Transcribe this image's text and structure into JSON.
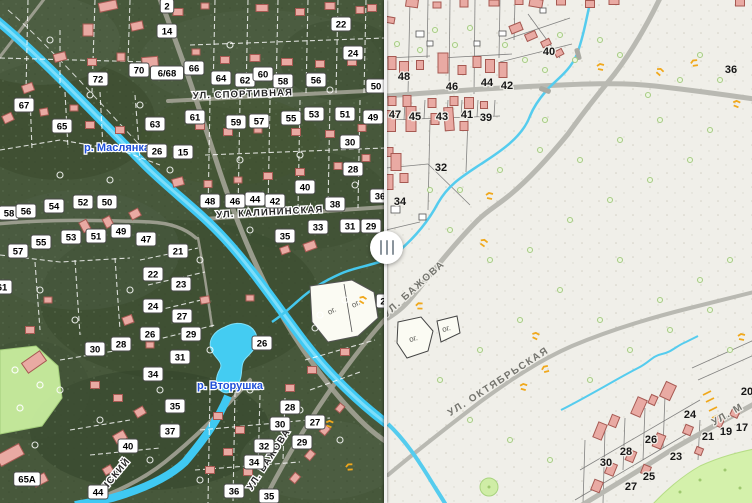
{
  "compare_slider": {
    "grip_icon": "drag-handle-icon",
    "position_x": 386
  },
  "left_map": {
    "style": "satellite-with-cadastral-overlay",
    "street_labels": [
      {
        "text": "УЛ. СПОРТИВНАЯ",
        "x": 243,
        "y": 97,
        "rotate": -2
      },
      {
        "text": "УЛ. КАЛИНИНСКАЯ",
        "x": 270,
        "y": 215,
        "rotate": -3
      },
      {
        "text": "УЛ. БАЖОВА",
        "x": 271,
        "y": 461,
        "rotate": -57
      },
      {
        "text": "НСКИЙ",
        "x": 118,
        "y": 476,
        "rotate": -50
      }
    ],
    "water_labels": [
      {
        "text": "р. Маслянка",
        "x": 117,
        "y": 151
      },
      {
        "text": "р. Вторушка",
        "x": 230,
        "y": 389
      }
    ],
    "parcel_labels": [
      {
        "text": "ог.",
        "x": 333,
        "y": 313,
        "rotate": -28
      },
      {
        "text": "ог.",
        "x": 357,
        "y": 306,
        "rotate": -28
      }
    ],
    "house_numbers": [
      {
        "n": "2",
        "x": 167,
        "y": 6
      },
      {
        "n": "14",
        "x": 167,
        "y": 31
      },
      {
        "n": "72",
        "x": 98,
        "y": 79
      },
      {
        "n": "70",
        "x": 139,
        "y": 70
      },
      {
        "n": "6/68",
        "x": 167,
        "y": 73
      },
      {
        "n": "66",
        "x": 194,
        "y": 68
      },
      {
        "n": "67",
        "x": 24,
        "y": 105
      },
      {
        "n": "65",
        "x": 62,
        "y": 126
      },
      {
        "n": "22",
        "x": 341,
        "y": 24
      },
      {
        "n": "24",
        "x": 353,
        "y": 53
      },
      {
        "n": "64",
        "x": 221,
        "y": 78
      },
      {
        "n": "62",
        "x": 245,
        "y": 80
      },
      {
        "n": "60",
        "x": 263,
        "y": 74
      },
      {
        "n": "58",
        "x": 283,
        "y": 81
      },
      {
        "n": "56",
        "x": 316,
        "y": 80
      },
      {
        "n": "50",
        "x": 376,
        "y": 86
      },
      {
        "n": "61",
        "x": 195,
        "y": 117
      },
      {
        "n": "59",
        "x": 236,
        "y": 122
      },
      {
        "n": "57",
        "x": 259,
        "y": 121
      },
      {
        "n": "55",
        "x": 291,
        "y": 118
      },
      {
        "n": "53",
        "x": 314,
        "y": 114
      },
      {
        "n": "51",
        "x": 345,
        "y": 114
      },
      {
        "n": "49",
        "x": 373,
        "y": 117
      },
      {
        "n": "63",
        "x": 155,
        "y": 124
      },
      {
        "n": "15",
        "x": 183,
        "y": 152
      },
      {
        "n": "26",
        "x": 157,
        "y": 151
      },
      {
        "n": "30",
        "x": 350,
        "y": 142
      },
      {
        "n": "28",
        "x": 353,
        "y": 169
      },
      {
        "n": "40",
        "x": 305,
        "y": 187
      },
      {
        "n": "48",
        "x": 210,
        "y": 201
      },
      {
        "n": "46",
        "x": 235,
        "y": 201
      },
      {
        "n": "44",
        "x": 255,
        "y": 199
      },
      {
        "n": "42",
        "x": 275,
        "y": 201
      },
      {
        "n": "38",
        "x": 335,
        "y": 204
      },
      {
        "n": "36",
        "x": 380,
        "y": 196
      },
      {
        "n": "33",
        "x": 318,
        "y": 227
      },
      {
        "n": "31",
        "x": 350,
        "y": 226
      },
      {
        "n": "29",
        "x": 371,
        "y": 226
      },
      {
        "n": "35",
        "x": 285,
        "y": 236
      },
      {
        "n": "58",
        "x": 9,
        "y": 213
      },
      {
        "n": "56",
        "x": 26,
        "y": 211
      },
      {
        "n": "54",
        "x": 54,
        "y": 206
      },
      {
        "n": "52",
        "x": 83,
        "y": 202
      },
      {
        "n": "50",
        "x": 107,
        "y": 202
      },
      {
        "n": "57",
        "x": 18,
        "y": 251
      },
      {
        "n": "55",
        "x": 41,
        "y": 242
      },
      {
        "n": "53",
        "x": 71,
        "y": 237
      },
      {
        "n": "51",
        "x": 96,
        "y": 236
      },
      {
        "n": "49",
        "x": 121,
        "y": 231
      },
      {
        "n": "47",
        "x": 146,
        "y": 239
      },
      {
        "n": "21",
        "x": 178,
        "y": 251
      },
      {
        "n": "22",
        "x": 153,
        "y": 274
      },
      {
        "n": "23",
        "x": 181,
        "y": 284
      },
      {
        "n": "24",
        "x": 153,
        "y": 306
      },
      {
        "n": "27",
        "x": 182,
        "y": 316
      },
      {
        "n": "26",
        "x": 150,
        "y": 334
      },
      {
        "n": "29",
        "x": 191,
        "y": 334
      },
      {
        "n": "61",
        "x": 2,
        "y": 287
      },
      {
        "n": "30",
        "x": 95,
        "y": 349
      },
      {
        "n": "28",
        "x": 121,
        "y": 344
      },
      {
        "n": "31",
        "x": 180,
        "y": 357
      },
      {
        "n": "34",
        "x": 153,
        "y": 374
      },
      {
        "n": "35",
        "x": 175,
        "y": 406
      },
      {
        "n": "37",
        "x": 170,
        "y": 431
      },
      {
        "n": "40",
        "x": 128,
        "y": 446
      },
      {
        "n": "44",
        "x": 98,
        "y": 492
      },
      {
        "n": "65А",
        "x": 27,
        "y": 479
      },
      {
        "n": "26",
        "x": 262,
        "y": 343
      },
      {
        "n": "28",
        "x": 290,
        "y": 407
      },
      {
        "n": "30",
        "x": 280,
        "y": 424
      },
      {
        "n": "32",
        "x": 264,
        "y": 446
      },
      {
        "n": "34",
        "x": 254,
        "y": 462
      },
      {
        "n": "36",
        "x": 234,
        "y": 491
      },
      {
        "n": "35",
        "x": 269,
        "y": 496
      },
      {
        "n": "29",
        "x": 302,
        "y": 442
      },
      {
        "n": "27",
        "x": 315,
        "y": 422
      },
      {
        "n": "2",
        "x": 383,
        "y": 301
      }
    ]
  },
  "right_map": {
    "style": "vector-cadastral",
    "street_labels": [
      {
        "text": "УЛ. БАЖОВА",
        "x": 416,
        "y": 291,
        "rotate": -42
      },
      {
        "text": "УЛ. ОКТЯБРЬСКАЯ",
        "x": 500,
        "y": 384,
        "rotate": -33
      },
      {
        "text": "УЛ. М",
        "x": 729,
        "y": 417,
        "rotate": -30
      }
    ],
    "parcel_labels": [
      {
        "text": "ог.",
        "x": 414,
        "y": 341,
        "rotate": -15
      },
      {
        "text": "ог.",
        "x": 447,
        "y": 331,
        "rotate": -15
      }
    ],
    "house_numbers": [
      {
        "n": "48",
        "x": 404,
        "y": 76
      },
      {
        "n": "46",
        "x": 452,
        "y": 86
      },
      {
        "n": "44",
        "x": 487,
        "y": 82
      },
      {
        "n": "42",
        "x": 507,
        "y": 85
      },
      {
        "n": "40",
        "x": 549,
        "y": 51
      },
      {
        "n": "47",
        "x": 395,
        "y": 114
      },
      {
        "n": "45",
        "x": 415,
        "y": 116
      },
      {
        "n": "43",
        "x": 442,
        "y": 116
      },
      {
        "n": "41",
        "x": 467,
        "y": 114
      },
      {
        "n": "39",
        "x": 486,
        "y": 117
      },
      {
        "n": "36",
        "x": 731,
        "y": 69
      },
      {
        "n": "32",
        "x": 441,
        "y": 167
      },
      {
        "n": "34",
        "x": 400,
        "y": 201
      },
      {
        "n": "24",
        "x": 690,
        "y": 414
      },
      {
        "n": "26",
        "x": 651,
        "y": 439
      },
      {
        "n": "28",
        "x": 626,
        "y": 451
      },
      {
        "n": "30",
        "x": 606,
        "y": 462
      },
      {
        "n": "21",
        "x": 708,
        "y": 436
      },
      {
        "n": "19",
        "x": 726,
        "y": 431
      },
      {
        "n": "17",
        "x": 742,
        "y": 427
      },
      {
        "n": "23",
        "x": 676,
        "y": 456
      },
      {
        "n": "25",
        "x": 649,
        "y": 476
      },
      {
        "n": "27",
        "x": 631,
        "y": 486
      },
      {
        "n": "20",
        "x": 747,
        "y": 391
      }
    ]
  },
  "colors": {
    "water": "#49c9ee",
    "water_label": "#2050d8",
    "building_fill": "#e9aaa3",
    "building_stroke": "#a65952",
    "road": "#b9b9b2",
    "vector_bg": "#f0efe9",
    "satellite_bg": "#47583b",
    "orange_symbol": "#f0a81c",
    "bubble_bg": "#ffffff",
    "bubble_border": "#4a4a4a",
    "park": "#cdeca2"
  }
}
